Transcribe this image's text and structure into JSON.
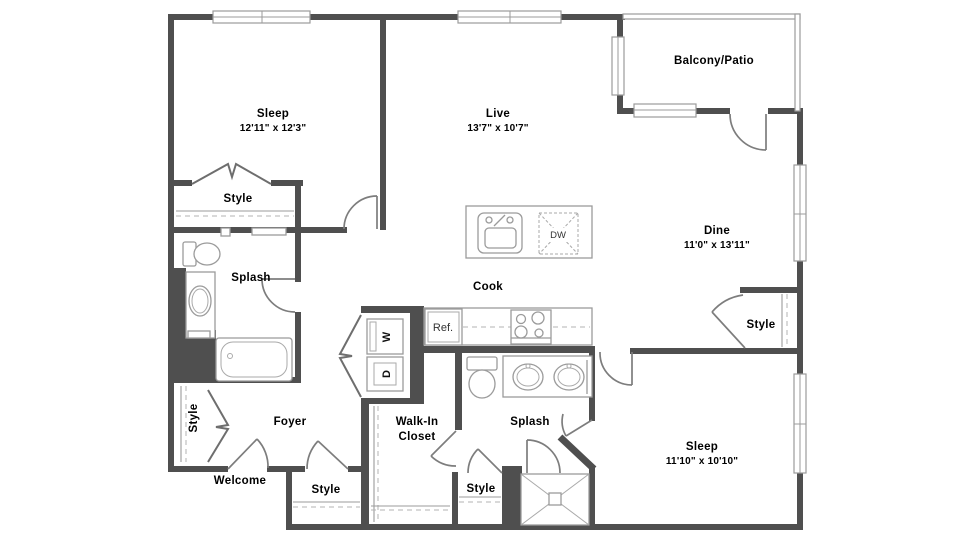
{
  "meta": {
    "type": "apartment-floor-plan",
    "background_color": "#ffffff",
    "wall_color": "#4f4f4f",
    "fixture_line_color": "#9b9b9b",
    "text_color": "#000000"
  },
  "rooms": {
    "sleep1": {
      "label": "Sleep",
      "dims": "12'11\" x 12'3\""
    },
    "live": {
      "label": "Live",
      "dims": "13'7\" x 10'7\""
    },
    "balcony": {
      "label": "Balcony/Patio"
    },
    "dine": {
      "label": "Dine",
      "dims": "11'0\" x 13'11\""
    },
    "cook": {
      "label": "Cook"
    },
    "splash_main": {
      "label": "Splash"
    },
    "splash_master": {
      "label": "Splash"
    },
    "foyer": {
      "label": "Foyer"
    },
    "welcome": {
      "label": "Welcome"
    },
    "walk_in_closet": {
      "line1": "Walk-In",
      "line2": "Closet"
    },
    "sleep2": {
      "label": "Sleep",
      "dims": "11'10\" x 10'10\""
    }
  },
  "closets": {
    "style_sleep1": {
      "label": "Style"
    },
    "style_foyer": {
      "label": "Style"
    },
    "style_entry": {
      "label": "Style"
    },
    "style_bath": {
      "label": "Style"
    },
    "style_dine": {
      "label": "Style"
    }
  },
  "appliances": {
    "washer": "W",
    "dryer": "D",
    "refrigerator": "Ref.",
    "dishwasher": "DW"
  }
}
